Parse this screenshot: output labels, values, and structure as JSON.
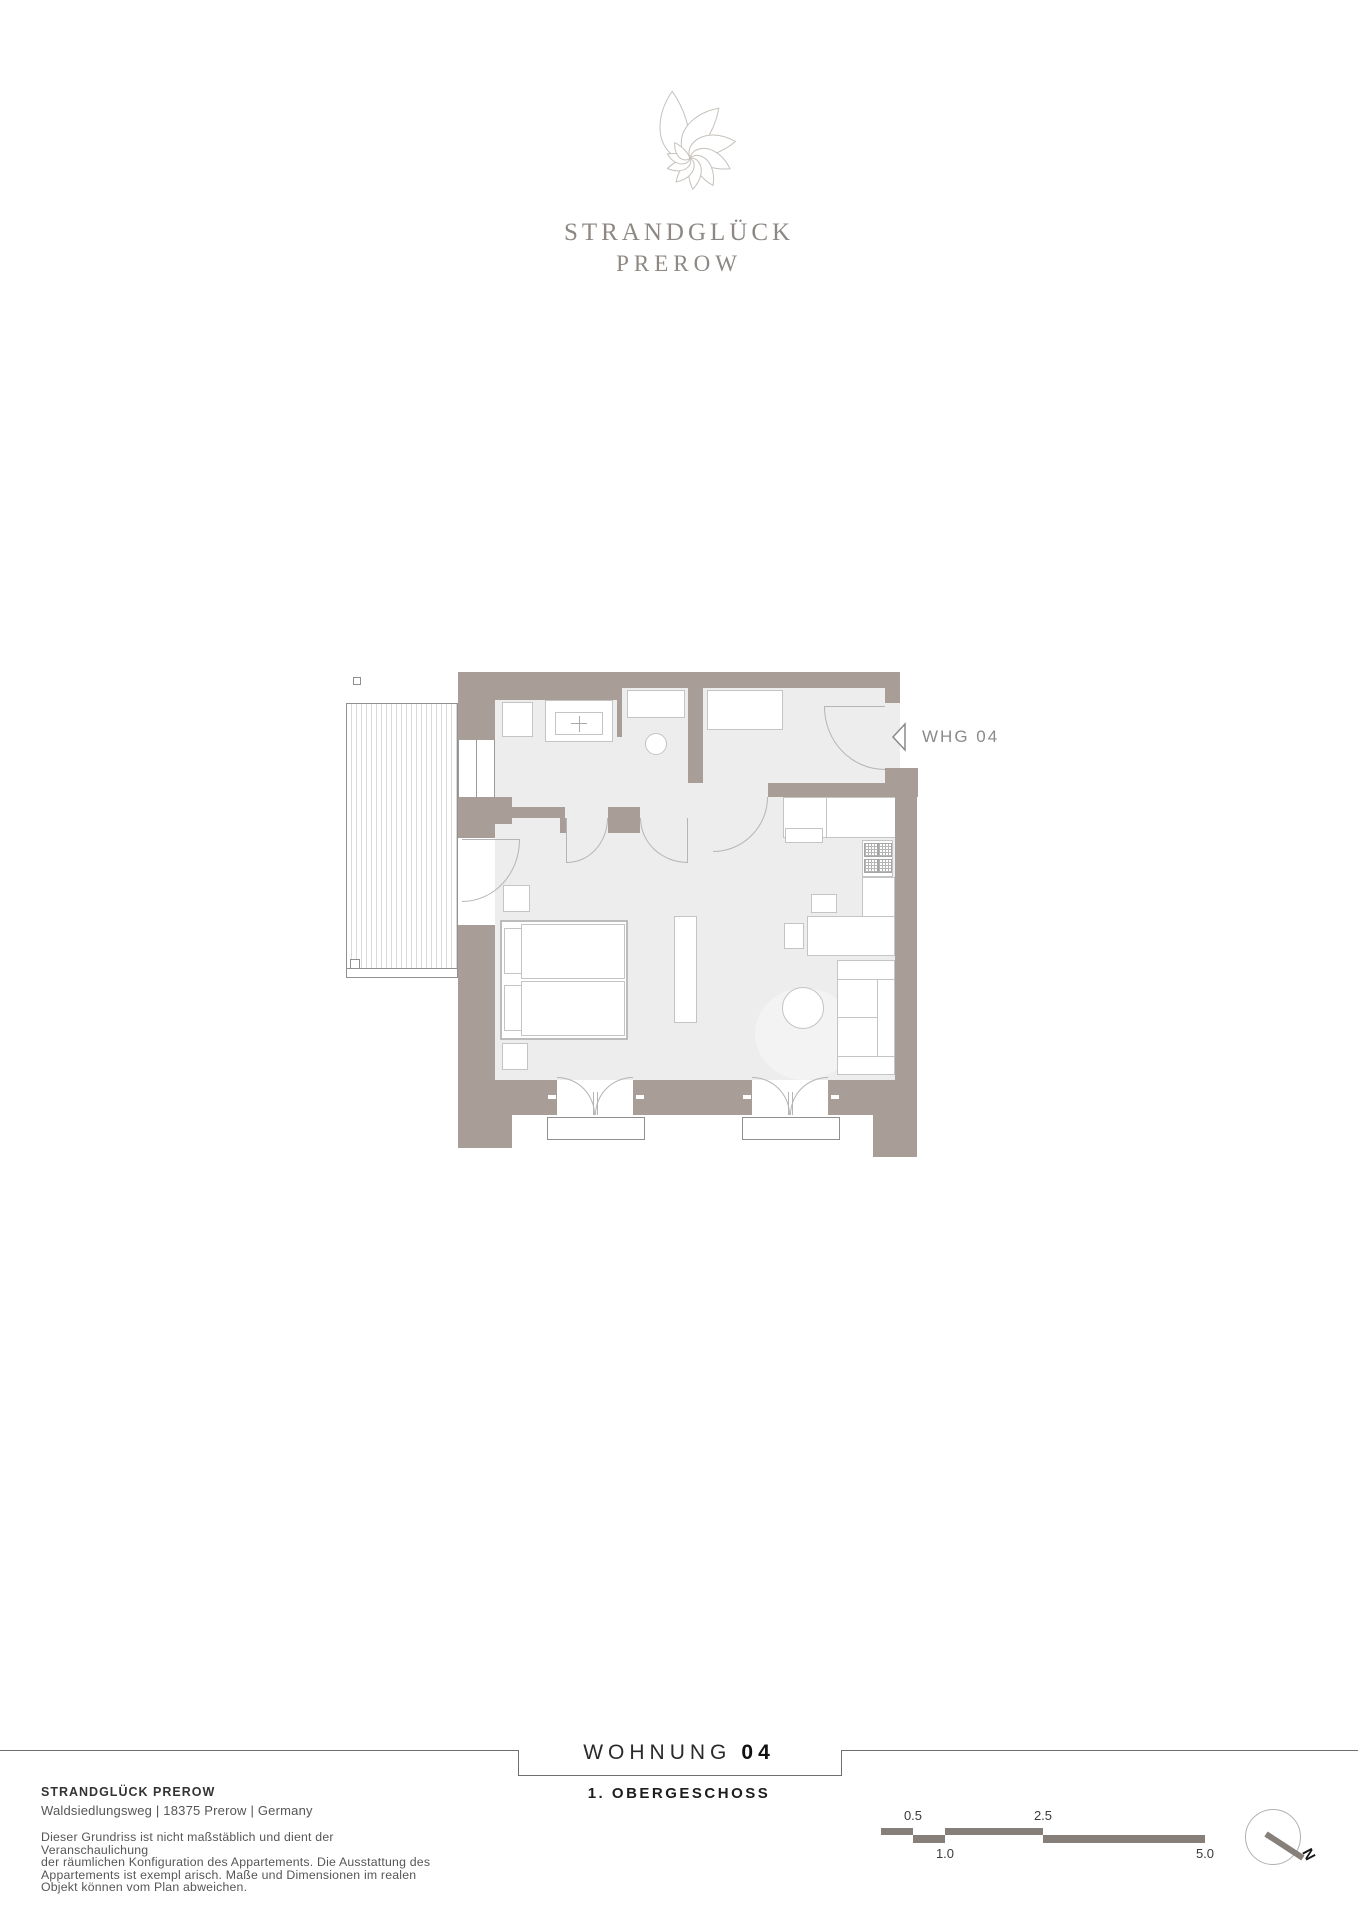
{
  "logo": {
    "title": "STRANDGLÜCK",
    "subtitle": "PREROW"
  },
  "plan": {
    "unit_label": "WHG 04",
    "rooms": [
      "bathroom",
      "shower-room",
      "entry-hall",
      "kitchen",
      "living-bedroom",
      "balcony"
    ],
    "furniture": [
      "washing-machine",
      "vanity-sink",
      "shower",
      "toilet",
      "wardrobe",
      "kitchen-counter",
      "cooktop",
      "desk",
      "chair",
      "sideboard",
      "round-table",
      "sofa",
      "double-bed",
      "nightstands"
    ]
  },
  "title_block": {
    "title": "WOHNUNG",
    "number": "04",
    "floor": "1. OBERGESCHOSS"
  },
  "footer": {
    "company": "STRANDGLÜCK PREROW",
    "address": "Waldsiedlungsweg | 18375 Prerow | Germany",
    "disclaimer_lines": [
      "Dieser Grundriss ist nicht maßstäblich und dient der Veranschaulichung",
      "der räumlichen Konfiguration des Appartements. Die Ausstattung des",
      "Appartements ist exempl arisch. Maße und Dimensionen im realen",
      "Objekt können vom Plan abweichen."
    ]
  },
  "scale_bar": {
    "labels_top": [
      "0.5",
      "2.5"
    ],
    "labels_bottom": [
      "1.0",
      "5.0"
    ],
    "unit": "m"
  },
  "compass": {
    "label": "N"
  },
  "colors": {
    "wall": "#a89e97",
    "floor": "#ededee",
    "furniture_outline": "#c4c4c4",
    "scale_bar": "#867e78",
    "logo_text": "#8d8883",
    "label_gray": "#8a8a8a"
  }
}
